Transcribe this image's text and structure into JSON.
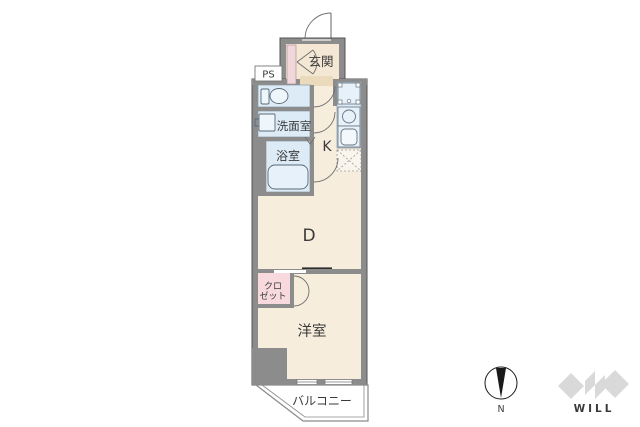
{
  "floorplan": {
    "labels": {
      "entrance": "玄関",
      "pipe_space": "PS",
      "washroom": "洗面室",
      "bathroom": "浴室",
      "kitchen": "K",
      "dining": "D",
      "closet_line1": "クロ",
      "closet_line2": "ゼット",
      "bedroom": "洋室",
      "balcony": "バルコニー"
    },
    "compass": {
      "north_label": "N"
    },
    "logo": {
      "text": "WILL"
    },
    "colors": {
      "wall": "#8c8c8c",
      "wall_stroke": "#545454",
      "floor_beige": "#f6eddd",
      "entry_floor": "#f4e8d4",
      "entry_step": "#ecdabd",
      "wet_area_blue": "#dcebf5",
      "fixture_blue": "#e7f1f9",
      "closet_pink": "#f7d9de",
      "outline_gray": "#6e6e6e",
      "logo_gray": "#d9d9d9"
    }
  }
}
